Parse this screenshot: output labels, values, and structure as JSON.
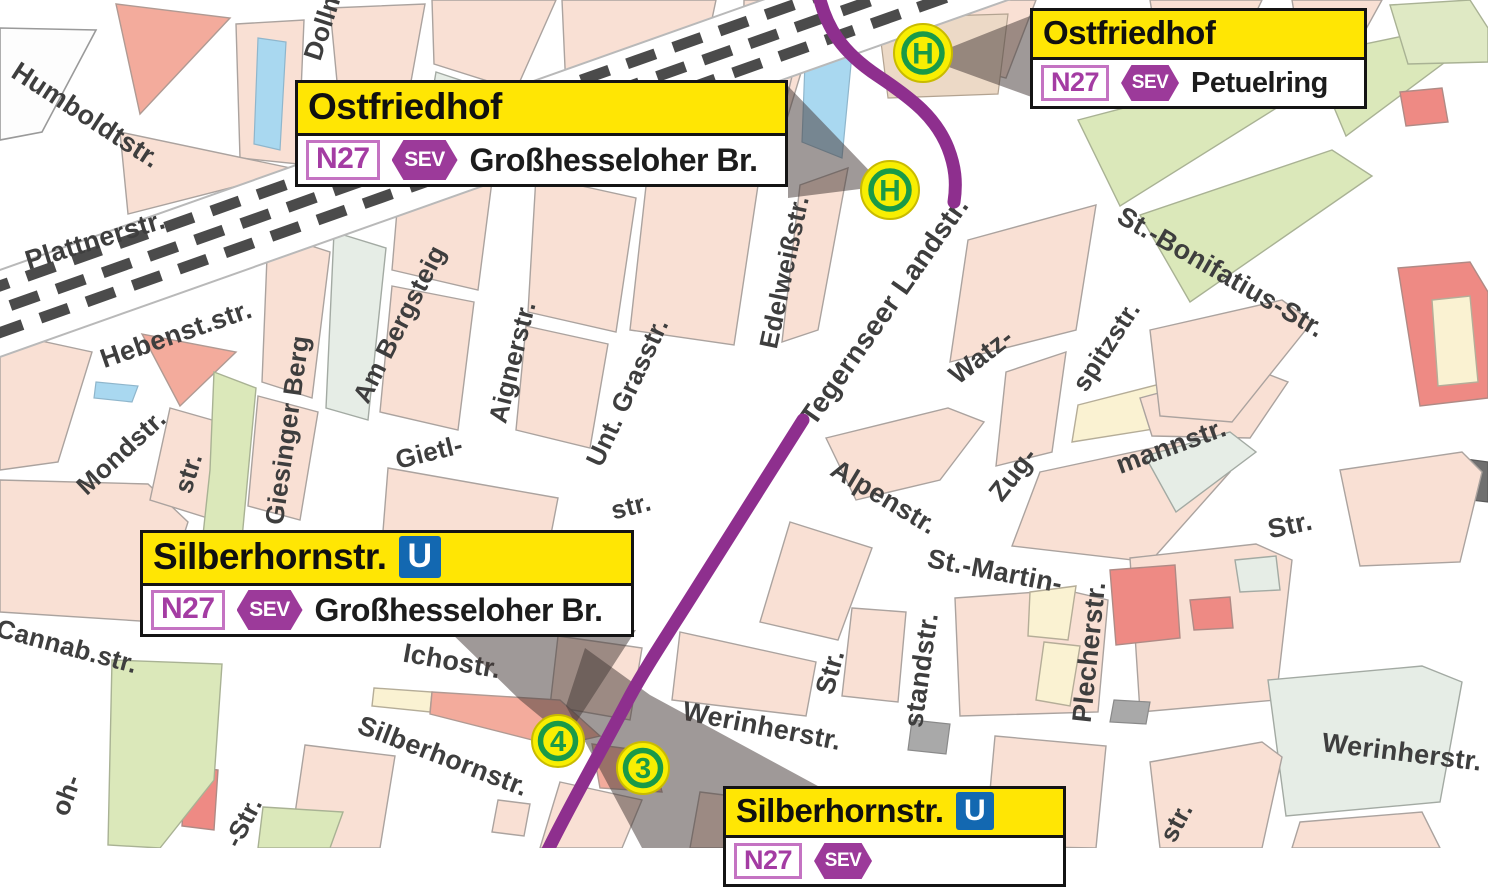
{
  "map": {
    "h_symbol": "H",
    "metro_symbol": "U",
    "colors": {
      "route_purple": "#8e2f8e",
      "label_yellow": "#ffe604",
      "sev_purple": "#9c3a9a",
      "n27_purple": "#a43ca3",
      "metro_blue": "#1368b1",
      "stop_green": "#199a48",
      "stop_yellow": "#f8ee02",
      "street_text": "#3e3e3e"
    },
    "street_labels": [
      {
        "t": "Humboldtstr.",
        "x": 86,
        "y": 115,
        "r": 33,
        "s": 27
      },
      {
        "t": "Plattnerstr.",
        "x": 95,
        "y": 240,
        "r": -17,
        "s": 27
      },
      {
        "t": "Hebenst.str.",
        "x": 176,
        "y": 334,
        "r": -19,
        "s": 27
      },
      {
        "t": "Mondstr.",
        "x": 121,
        "y": 452,
        "r": -43,
        "s": 26
      },
      {
        "t": "str.",
        "x": 188,
        "y": 473,
        "r": -73,
        "s": 26
      },
      {
        "t": "Cannab.str.",
        "x": 67,
        "y": 646,
        "r": 15,
        "s": 26
      },
      {
        "t": "oh-",
        "x": 66,
        "y": 795,
        "r": -70,
        "s": 26
      },
      {
        "t": "-Str.",
        "x": 243,
        "y": 822,
        "r": -63,
        "s": 26
      },
      {
        "t": "Giesinger Berg",
        "x": 287,
        "y": 430,
        "r": -82,
        "s": 26
      },
      {
        "t": "Am Bergsteig",
        "x": 399,
        "y": 324,
        "r": -63,
        "s": 26
      },
      {
        "t": "Aignerstr.",
        "x": 512,
        "y": 362,
        "r": -76,
        "s": 26
      },
      {
        "t": "Unt. Grasstr.",
        "x": 627,
        "y": 392,
        "r": -65,
        "s": 26
      },
      {
        "t": "Gietl-",
        "x": 429,
        "y": 452,
        "r": -14,
        "s": 26
      },
      {
        "t": "str.",
        "x": 631,
        "y": 506,
        "r": -14,
        "s": 26
      },
      {
        "t": "Dollm",
        "x": 323,
        "y": 24,
        "r": -72,
        "s": 26
      },
      {
        "t": "Edelweißstr.",
        "x": 784,
        "y": 272,
        "r": -78,
        "s": 26
      },
      {
        "t": "Tegernseer Landstr.",
        "x": 884,
        "y": 311,
        "r": -55,
        "s": 28
      },
      {
        "t": "Watz-",
        "x": 981,
        "y": 356,
        "r": -38,
        "s": 27
      },
      {
        "t": "spitzstr.",
        "x": 1106,
        "y": 346,
        "r": -57,
        "s": 26
      },
      {
        "t": "mannstr.",
        "x": 1171,
        "y": 446,
        "r": -20,
        "s": 27
      },
      {
        "t": "Zug-",
        "x": 1013,
        "y": 474,
        "r": -52,
        "s": 27
      },
      {
        "t": "St.-Bonifatius-Str.",
        "x": 1221,
        "y": 272,
        "r": 30,
        "s": 27
      },
      {
        "t": "Str.",
        "x": 1290,
        "y": 525,
        "r": -12,
        "s": 27
      },
      {
        "t": "Alpenstr.",
        "x": 884,
        "y": 497,
        "r": 31,
        "s": 27
      },
      {
        "t": "St.-Martin-",
        "x": 995,
        "y": 571,
        "r": 11,
        "s": 27
      },
      {
        "t": "Str.",
        "x": 830,
        "y": 672,
        "r": -75,
        "s": 27
      },
      {
        "t": "standstr.",
        "x": 921,
        "y": 670,
        "r": -82,
        "s": 27
      },
      {
        "t": "Plecherstr.",
        "x": 1089,
        "y": 652,
        "r": -84,
        "s": 27
      },
      {
        "t": "Werinherstr.",
        "x": 762,
        "y": 726,
        "r": 11,
        "s": 27
      },
      {
        "t": "Werinherstr.",
        "x": 1402,
        "y": 752,
        "r": 7,
        "s": 27
      },
      {
        "t": "Ichostr.",
        "x": 452,
        "y": 661,
        "r": 10,
        "s": 27
      },
      {
        "t": "Silberhornstr.",
        "x": 443,
        "y": 756,
        "r": 21,
        "s": 27
      },
      {
        "t": "str.",
        "x": 1176,
        "y": 822,
        "r": -62,
        "s": 26
      }
    ]
  },
  "stops": {
    "h_stops": [
      {
        "x": 923,
        "y": 53
      },
      {
        "x": 890,
        "y": 190
      }
    ],
    "numbered_stops": [
      {
        "n": "4",
        "x": 558,
        "y": 741
      },
      {
        "n": "3",
        "x": 643,
        "y": 768
      }
    ]
  },
  "callouts": [
    {
      "title": "Ostfriedhof",
      "metro": false,
      "line": "N27",
      "mode": "SEV",
      "destination": "Großhesseloher Br.",
      "x": 295,
      "y": 80,
      "w": 493,
      "size": "lg"
    },
    {
      "title": "Ostfriedhof",
      "metro": false,
      "line": "N27",
      "mode": "SEV",
      "destination": "Petuelring",
      "x": 1030,
      "y": 8,
      "w": 337,
      "size": "md"
    },
    {
      "title": "Silberhornstr.",
      "metro": true,
      "line": "N27",
      "mode": "SEV",
      "destination": "Großhesseloher Br.",
      "x": 140,
      "y": 530,
      "w": 494,
      "size": "lg"
    },
    {
      "title": "Silberhornstr.",
      "metro": true,
      "line": "N27",
      "mode": "SEV",
      "destination": "",
      "x": 723,
      "y": 786,
      "w": 343,
      "size": "md"
    }
  ]
}
